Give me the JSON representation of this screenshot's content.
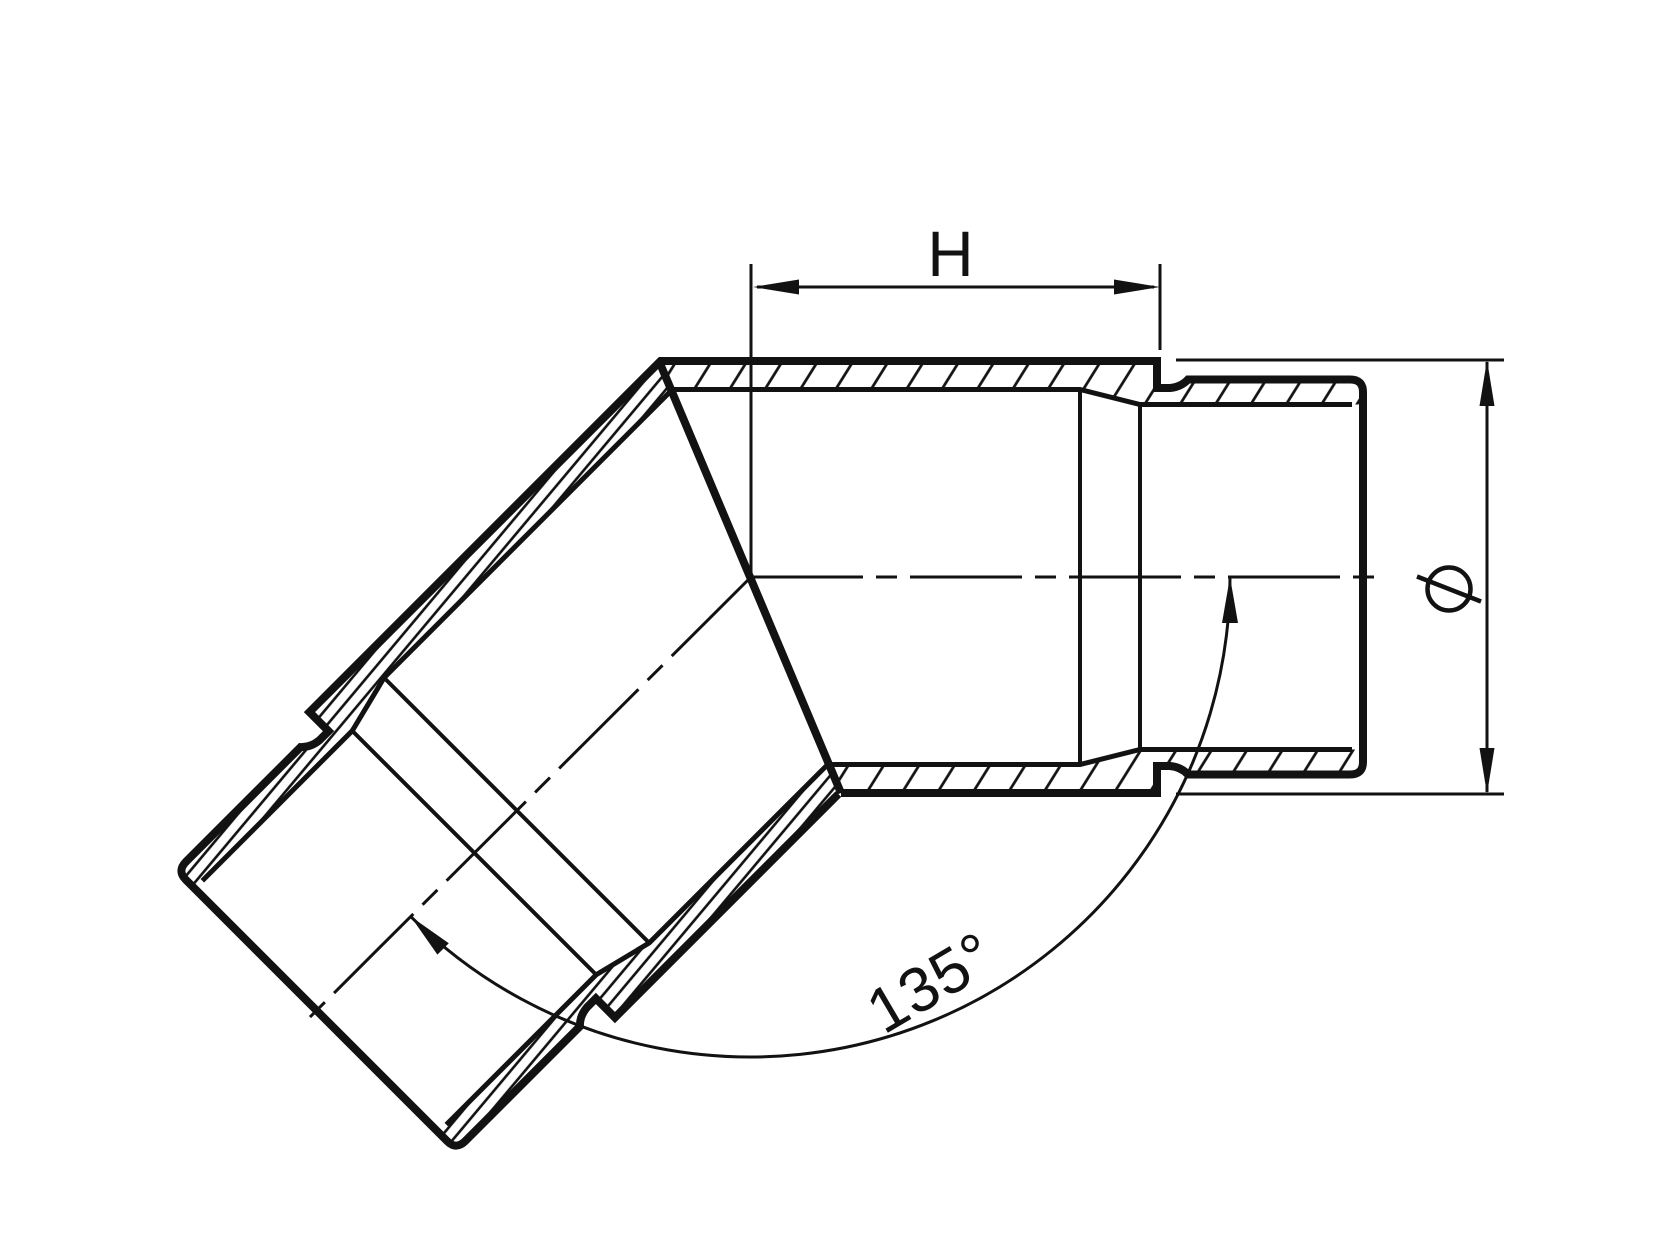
{
  "page": {
    "background_color": "#ffffff",
    "line_color": "#121212",
    "description": "Cross-section technical drawing of a 135-degree tube elbow fitting with hatched walls, two male spigot ends, centerlines and three dimension annotations"
  },
  "dimensions": {
    "horizontal_label": "H",
    "angle_label": "135°",
    "diameter_symbol": "⌀"
  }
}
